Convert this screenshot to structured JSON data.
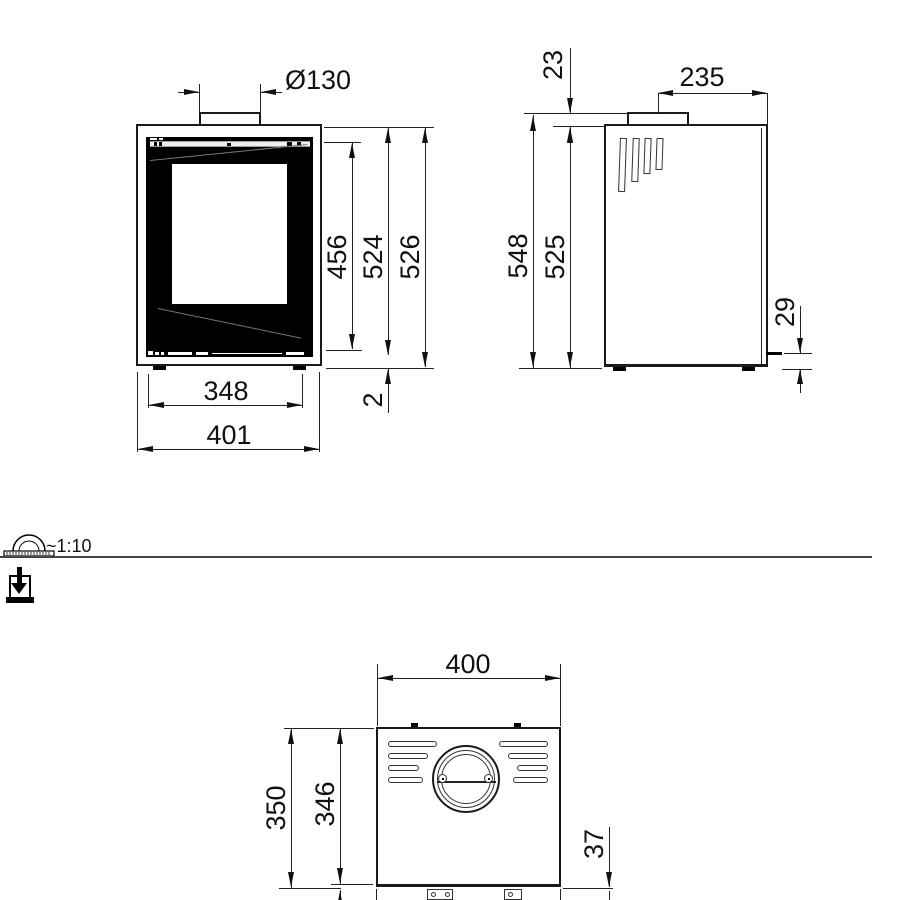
{
  "scalebar": {
    "label": "~1:10"
  },
  "icons": {
    "scale": "protractor-ruler-icon",
    "download": "download-icon"
  },
  "front": {
    "flue_diameter": "Ø130",
    "door_height": "456",
    "body_height": "524",
    "total_height": "526",
    "inner_width": "348",
    "total_width": "401",
    "base_gap": "2"
  },
  "side": {
    "collar_height": "23",
    "flue_center_to_back": "235",
    "total_height": "548",
    "body_height": "525",
    "lever_height": "29"
  },
  "top": {
    "width": "400",
    "depth_total": "350",
    "depth_body": "346",
    "front_offset": "37"
  }
}
